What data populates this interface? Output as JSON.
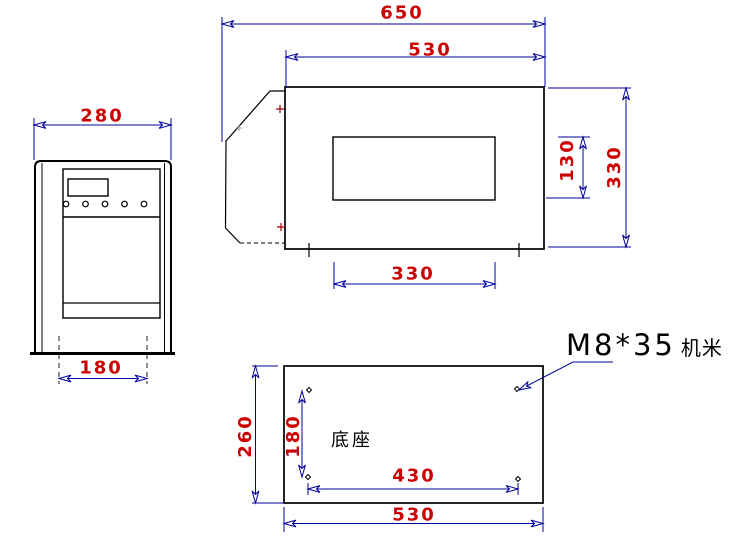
{
  "drawing": {
    "front_view": {
      "width_mm": "280",
      "mount_width_mm": "180"
    },
    "side_view": {
      "overall_width_mm": "650",
      "body_width_mm": "530",
      "window_width_mm": "330",
      "window_height_mm": "130",
      "height_mm": "330"
    },
    "base_view": {
      "label": "底座",
      "depth_mm": "260",
      "hole_pitch_depth_mm": "180",
      "hole_pitch_width_mm": "430",
      "width_mm": "530"
    },
    "note": {
      "screw_spec": "M8*35",
      "screw_type": "机米"
    },
    "colors": {
      "dimension_line": "#00009b",
      "dimension_text": "#cc0000",
      "outline": "#000000"
    }
  }
}
